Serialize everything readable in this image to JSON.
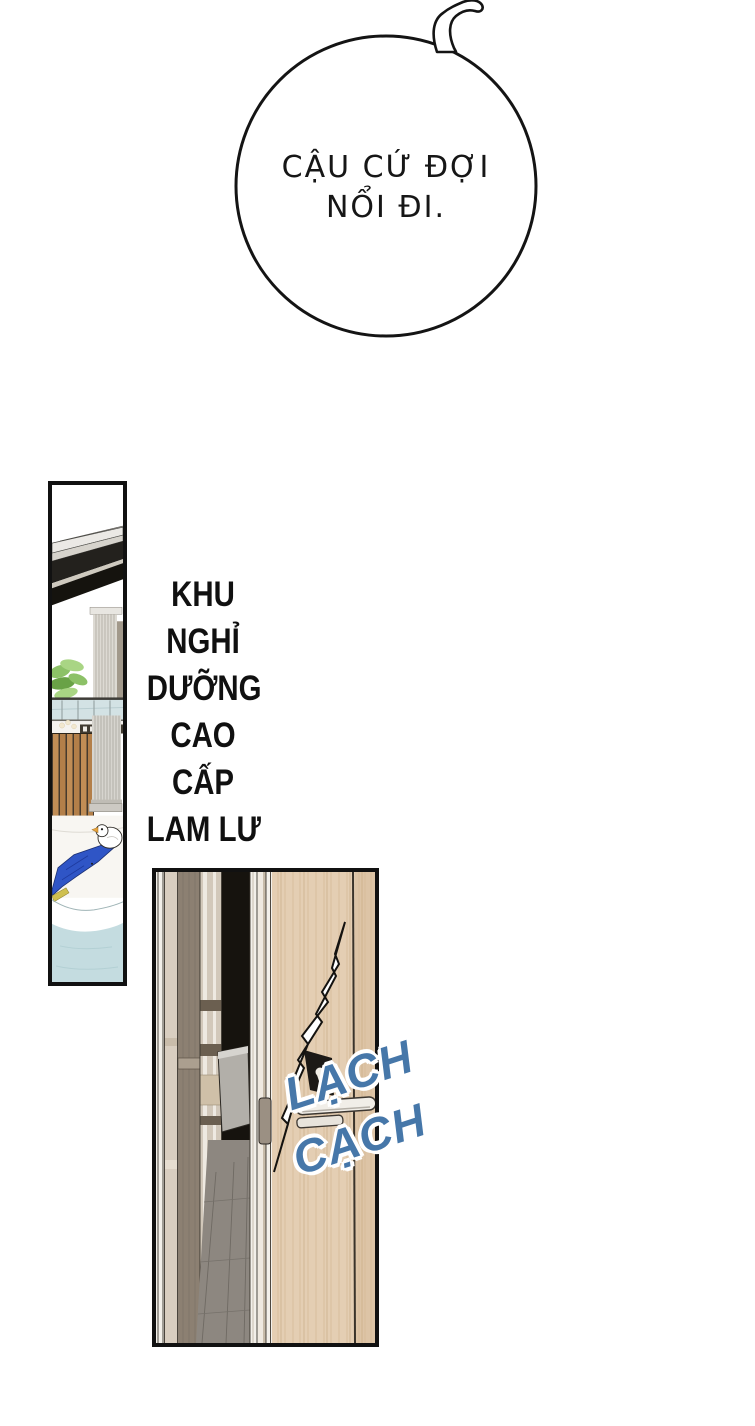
{
  "page": {
    "background_color": "#ffffff",
    "ink_color": "#141414"
  },
  "speech_bubble": {
    "full_text": "CẬU CỨ ĐỢI NỔI ĐI.",
    "line1": "CẬU CỨ ĐỢI",
    "line2": "NỔI ĐI.",
    "fill_color": "#ffffff",
    "outline_color": "#141414"
  },
  "location_caption": {
    "full_text": "KHU NGHỈ DƯỠNG CAO CẤP LAM LƯ",
    "lines": [
      "KHU",
      "NGHỈ",
      "DƯỠNG",
      "CAO",
      "CẤP",
      "LAM LƯ"
    ],
    "color": "#101010"
  },
  "sfx": {
    "word1": "LẠCH",
    "word2": "CẠCH",
    "color": "#4677a9",
    "outline_color": "#ffffff"
  },
  "palette": {
    "door_wood": "#e4ceb3",
    "door_wood_shadow": "#ddc4a6",
    "wall_taupe": "#8c8072",
    "wall_beige": "#d9cec0",
    "doorway_dark": "#16130e",
    "floor_grey": "#8d8780",
    "pool_water": "#c4dce0",
    "towel_blue": "#2f55c6",
    "slat_wood": "#c18d55",
    "plant_green": "#8cc167",
    "duck_beak_orange": "#e6a23c"
  }
}
